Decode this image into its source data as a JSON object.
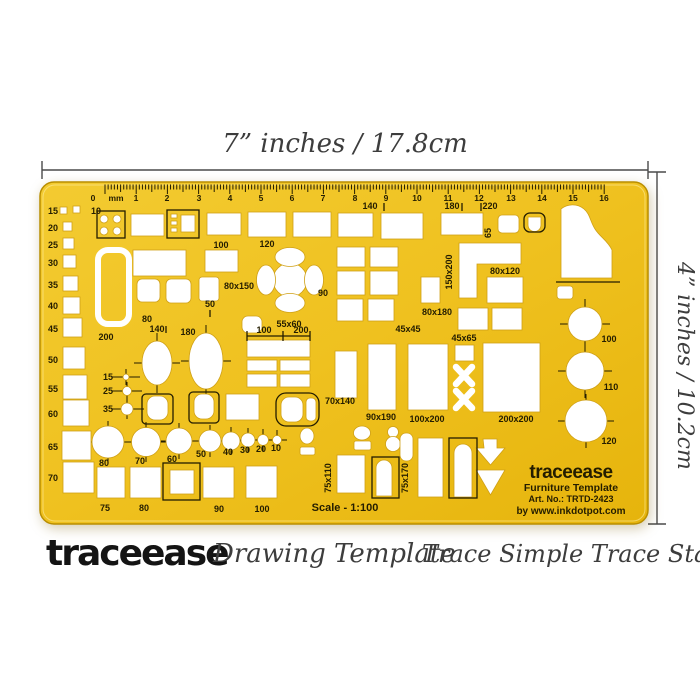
{
  "dimensions": {
    "top": "7” inches / 17.8cm",
    "right": "4” inches / 10.2cm"
  },
  "caption": {
    "brand": "traceease",
    "tagline": "Drawing Template",
    "slogan": "Trace Simple Trace Stable"
  },
  "template": {
    "body_color": "#EFC11F",
    "border_color": "#B98E00",
    "ink": "#241d00",
    "scale_label": "Scale - 1:100",
    "branding": {
      "name": "traceease",
      "product": "Furniture Template",
      "art_no": "Art. No.: TRTD-2423",
      "website": "by www.inkdotpot.com"
    },
    "labels": [
      {
        "t": "0",
        "x": 93,
        "y": 201,
        "s": 8.5
      },
      {
        "t": "mm",
        "x": 116,
        "y": 201,
        "s": 8.5
      },
      {
        "t": "1",
        "x": 136,
        "y": 201,
        "s": 8.5
      },
      {
        "t": "2",
        "x": 167,
        "y": 201,
        "s": 8.5
      },
      {
        "t": "3",
        "x": 199,
        "y": 201,
        "s": 8.5
      },
      {
        "t": "4",
        "x": 230,
        "y": 201,
        "s": 8.5
      },
      {
        "t": "5",
        "x": 261,
        "y": 201,
        "s": 8.5
      },
      {
        "t": "6",
        "x": 292,
        "y": 201,
        "s": 8.5
      },
      {
        "t": "7",
        "x": 323,
        "y": 201,
        "s": 8.5
      },
      {
        "t": "8",
        "x": 355,
        "y": 201,
        "s": 8.5
      },
      {
        "t": "9",
        "x": 386,
        "y": 201,
        "s": 8.5
      },
      {
        "t": "10",
        "x": 417,
        "y": 201,
        "s": 8.5
      },
      {
        "t": "11",
        "x": 448,
        "y": 201,
        "s": 8.5
      },
      {
        "t": "12",
        "x": 479,
        "y": 201,
        "s": 8.5
      },
      {
        "t": "13",
        "x": 511,
        "y": 201,
        "s": 8.5
      },
      {
        "t": "14",
        "x": 542,
        "y": 201,
        "s": 8.5
      },
      {
        "t": "15",
        "x": 573,
        "y": 201,
        "s": 8.5
      },
      {
        "t": "16",
        "x": 604,
        "y": 201,
        "s": 8.5
      },
      {
        "t": "15",
        "x": 58,
        "y": 214,
        "a": "end"
      },
      {
        "t": "10",
        "x": 96,
        "y": 214
      },
      {
        "t": "20",
        "x": 58,
        "y": 231,
        "a": "end"
      },
      {
        "t": "25",
        "x": 58,
        "y": 248,
        "a": "end"
      },
      {
        "t": "30",
        "x": 58,
        "y": 266,
        "a": "end"
      },
      {
        "t": "35",
        "x": 58,
        "y": 288,
        "a": "end"
      },
      {
        "t": "40",
        "x": 58,
        "y": 309,
        "a": "end"
      },
      {
        "t": "45",
        "x": 58,
        "y": 332,
        "a": "end"
      },
      {
        "t": "50",
        "x": 58,
        "y": 363,
        "a": "end"
      },
      {
        "t": "55",
        "x": 58,
        "y": 392,
        "a": "end"
      },
      {
        "t": "60",
        "x": 58,
        "y": 417,
        "a": "end"
      },
      {
        "t": "65",
        "x": 58,
        "y": 450,
        "a": "end"
      },
      {
        "t": "70",
        "x": 58,
        "y": 481,
        "a": "end"
      },
      {
        "t": "140",
        "x": 370,
        "y": 209
      },
      {
        "t": "180",
        "x": 452,
        "y": 209
      },
      {
        "t": "220",
        "x": 490,
        "y": 209
      },
      {
        "t": "65",
        "x": 491,
        "y": 233,
        "r": -90
      },
      {
        "t": "100",
        "x": 221,
        "y": 248
      },
      {
        "t": "120",
        "x": 267,
        "y": 247
      },
      {
        "t": "80x150",
        "x": 239,
        "y": 289
      },
      {
        "t": "90",
        "x": 323,
        "y": 296
      },
      {
        "t": "50",
        "x": 210,
        "y": 307
      },
      {
        "t": "55x60",
        "x": 289,
        "y": 327
      },
      {
        "t": "80",
        "x": 147,
        "y": 322
      },
      {
        "t": "140",
        "x": 157,
        "y": 332
      },
      {
        "t": "180",
        "x": 188,
        "y": 335
      },
      {
        "t": "200",
        "x": 106,
        "y": 340
      },
      {
        "t": "100",
        "x": 264,
        "y": 333
      },
      {
        "t": "200",
        "x": 301,
        "y": 333
      },
      {
        "t": "150x200",
        "x": 452,
        "y": 272,
        "r": -90
      },
      {
        "t": "80x120",
        "x": 505,
        "y": 274
      },
      {
        "t": "80x180",
        "x": 437,
        "y": 315
      },
      {
        "t": "45x45",
        "x": 408,
        "y": 332
      },
      {
        "t": "45x65",
        "x": 464,
        "y": 341
      },
      {
        "t": "15",
        "x": 113,
        "y": 380,
        "a": "end"
      },
      {
        "t": "25",
        "x": 113,
        "y": 394,
        "a": "end"
      },
      {
        "t": "35",
        "x": 113,
        "y": 412,
        "a": "end"
      },
      {
        "t": "70x140",
        "x": 340,
        "y": 404
      },
      {
        "t": "90x190",
        "x": 381,
        "y": 420
      },
      {
        "t": "100x200",
        "x": 427,
        "y": 422
      },
      {
        "t": "200x200",
        "x": 516,
        "y": 422
      },
      {
        "t": "100",
        "x": 609,
        "y": 342
      },
      {
        "t": "110",
        "x": 611,
        "y": 390
      },
      {
        "t": "120",
        "x": 609,
        "y": 444
      },
      {
        "t": "80",
        "x": 104,
        "y": 466
      },
      {
        "t": "70",
        "x": 140,
        "y": 464
      },
      {
        "t": "60",
        "x": 172,
        "y": 462
      },
      {
        "t": "50",
        "x": 201,
        "y": 457
      },
      {
        "t": "40",
        "x": 228,
        "y": 455
      },
      {
        "t": "30",
        "x": 245,
        "y": 453
      },
      {
        "t": "20",
        "x": 261,
        "y": 452
      },
      {
        "t": "10",
        "x": 276,
        "y": 451
      },
      {
        "t": "75",
        "x": 105,
        "y": 511
      },
      {
        "t": "80",
        "x": 144,
        "y": 511
      },
      {
        "t": "90",
        "x": 219,
        "y": 512
      },
      {
        "t": "100",
        "x": 262,
        "y": 512
      },
      {
        "t": "75x110",
        "x": 331,
        "y": 478,
        "r": -90
      },
      {
        "t": "75x170",
        "x": 408,
        "y": 478,
        "r": -90
      }
    ]
  }
}
